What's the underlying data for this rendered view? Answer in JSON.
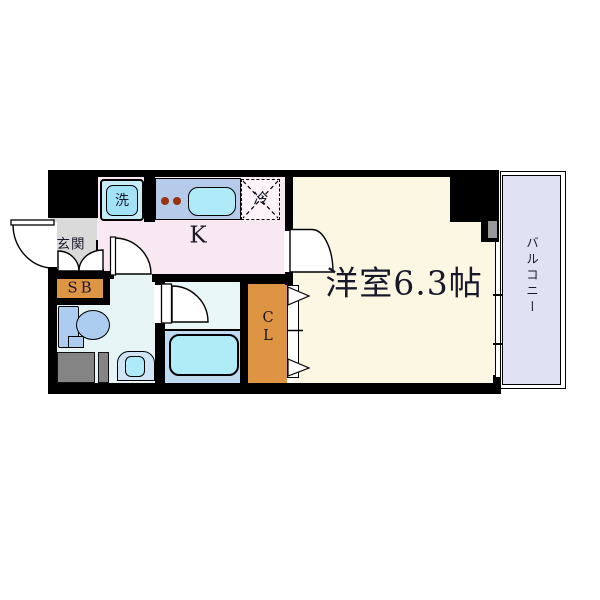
{
  "floorplan": {
    "rooms": {
      "main_room_label": "洋室6.3帖",
      "kitchen_label": "K",
      "entrance_label": "玄関",
      "shoebox_label": "SB",
      "closet_label_line1": "C",
      "closet_label_line2": "L",
      "washer_label": "洗",
      "fridge_label": "冷",
      "balcony_label": "バルコニー"
    },
    "palette": {
      "wall": "#000000",
      "kitchen_floor": "#f7e8f2",
      "main_room_floor": "#fbf7e2",
      "balcony": "#e0e1f3",
      "entrance_floor": "#dbdada",
      "storage_orange": "#dd9544",
      "counter_blue": "#b6cae9",
      "water_cyan": "#aeeaf8",
      "washroom_floor": "#e6f4f6",
      "bathroom_floor": "#bedbf2",
      "fixture_blue": "#accdef",
      "counter_gray": "#848484",
      "fridge_fill": "#fdf3f9",
      "washer_fill": "#c6ecf9"
    }
  }
}
